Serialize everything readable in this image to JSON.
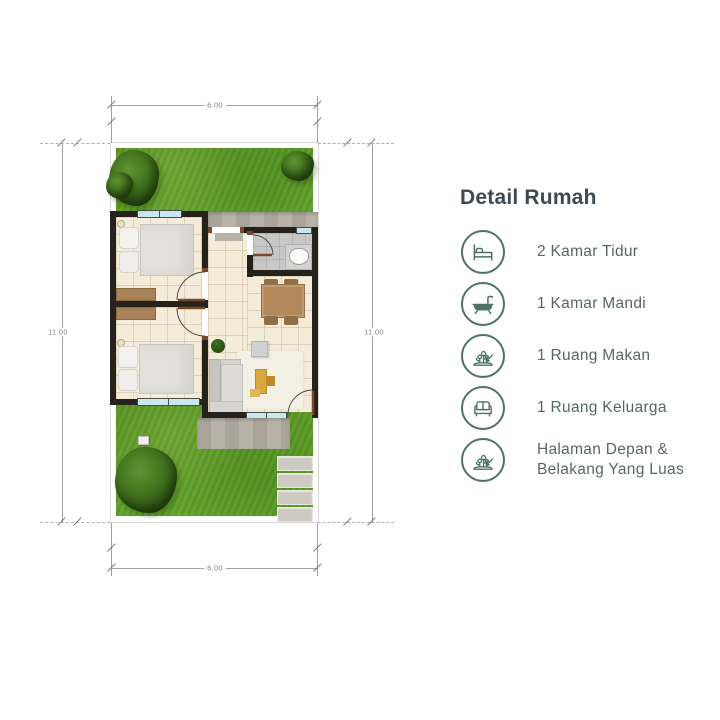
{
  "floorplan": {
    "dim_width_top": "6.00",
    "dim_width_bottom": "6.00",
    "dim_height_left": "11.00",
    "dim_height_right": "11.00"
  },
  "details": {
    "title": "Detail Rumah",
    "items": [
      {
        "icon": "bed-icon",
        "label": "2 Kamar Tidur"
      },
      {
        "icon": "bathtub-icon",
        "label": "1 Kamar Mandi"
      },
      {
        "icon": "garden-icon",
        "label": "1 Ruang Makan"
      },
      {
        "icon": "sofa-icon",
        "label": "1 Ruang Keluarga"
      },
      {
        "icon": "garden-icon",
        "label": "Halaman Depan & Belakang Yang Luas"
      }
    ]
  },
  "colors": {
    "accent": "#4e7265",
    "title": "#3d4a52",
    "text": "#56685d",
    "wall": "#25211b",
    "grass": "#69ab2f"
  }
}
